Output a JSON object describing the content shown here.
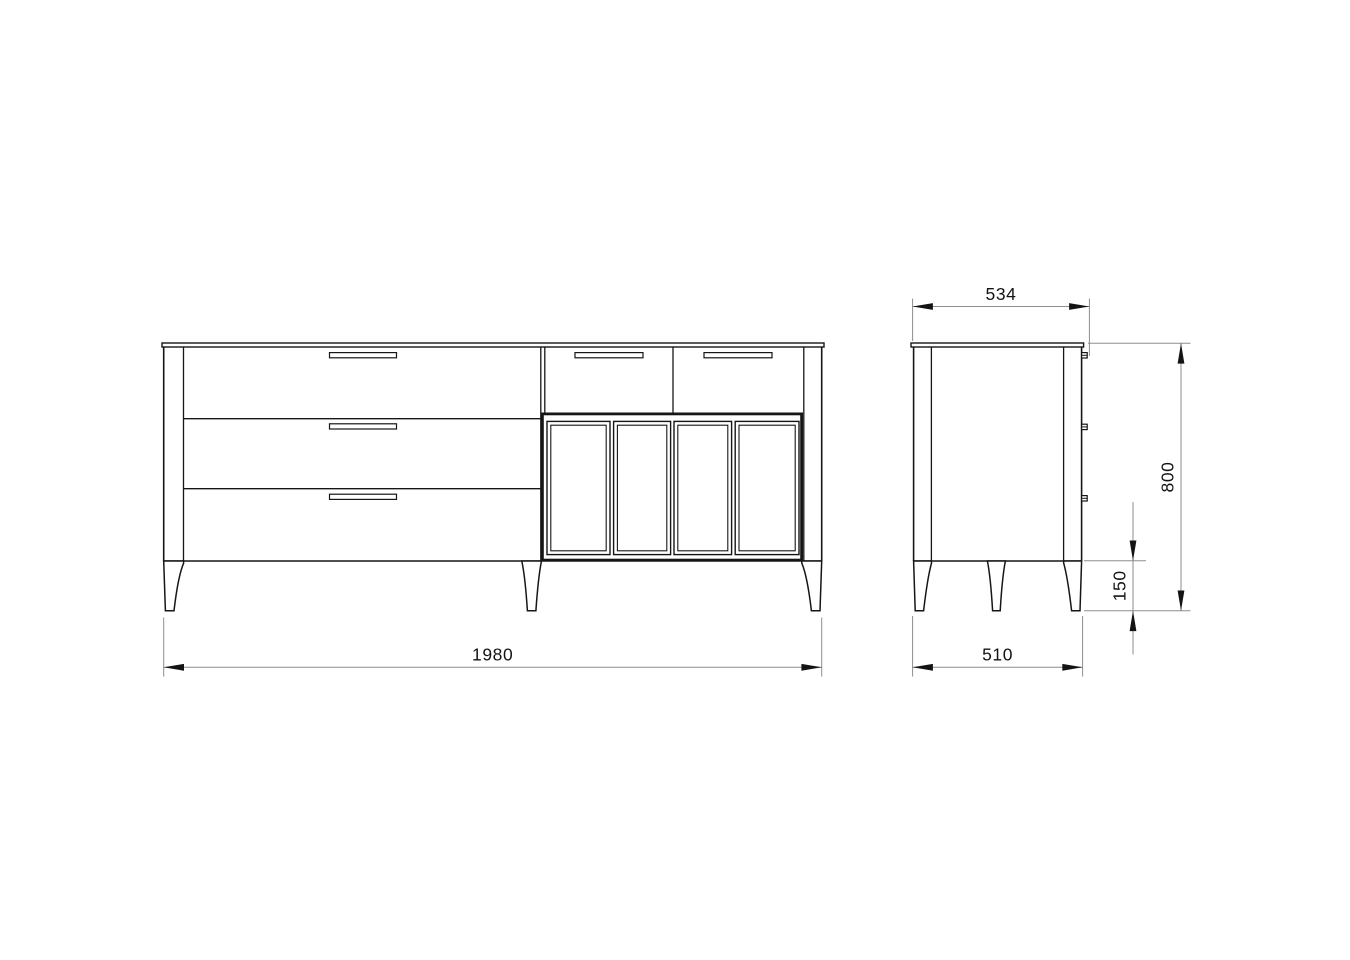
{
  "document": {
    "type": "furniture-dimension-drawing",
    "subject": "sideboard-cabinet",
    "background_color": "#ffffff",
    "outline_color": "#161616",
    "dimension_line_color": "#8d8d8d",
    "text_color": "#141414"
  },
  "front_view": {
    "name": "front-elevation",
    "wide_drawers_visible": 3,
    "small_drawers_visible": 2,
    "doors_visible": 4,
    "legs_visible": 3,
    "handles_visible": 5
  },
  "side_view": {
    "name": "side-elevation",
    "legs_visible": 3,
    "handle_profiles_visible": 3
  },
  "dimensions": {
    "width": {
      "value": "1980",
      "orientation": "horizontal",
      "view": "front"
    },
    "depth_top": {
      "value": "534",
      "orientation": "horizontal",
      "view": "side"
    },
    "height": {
      "value": "800",
      "orientation": "vertical",
      "view": "side"
    },
    "leg_height": {
      "value": "150",
      "orientation": "vertical",
      "view": "side"
    },
    "depth_bottom": {
      "value": "510",
      "orientation": "horizontal",
      "view": "side"
    }
  }
}
